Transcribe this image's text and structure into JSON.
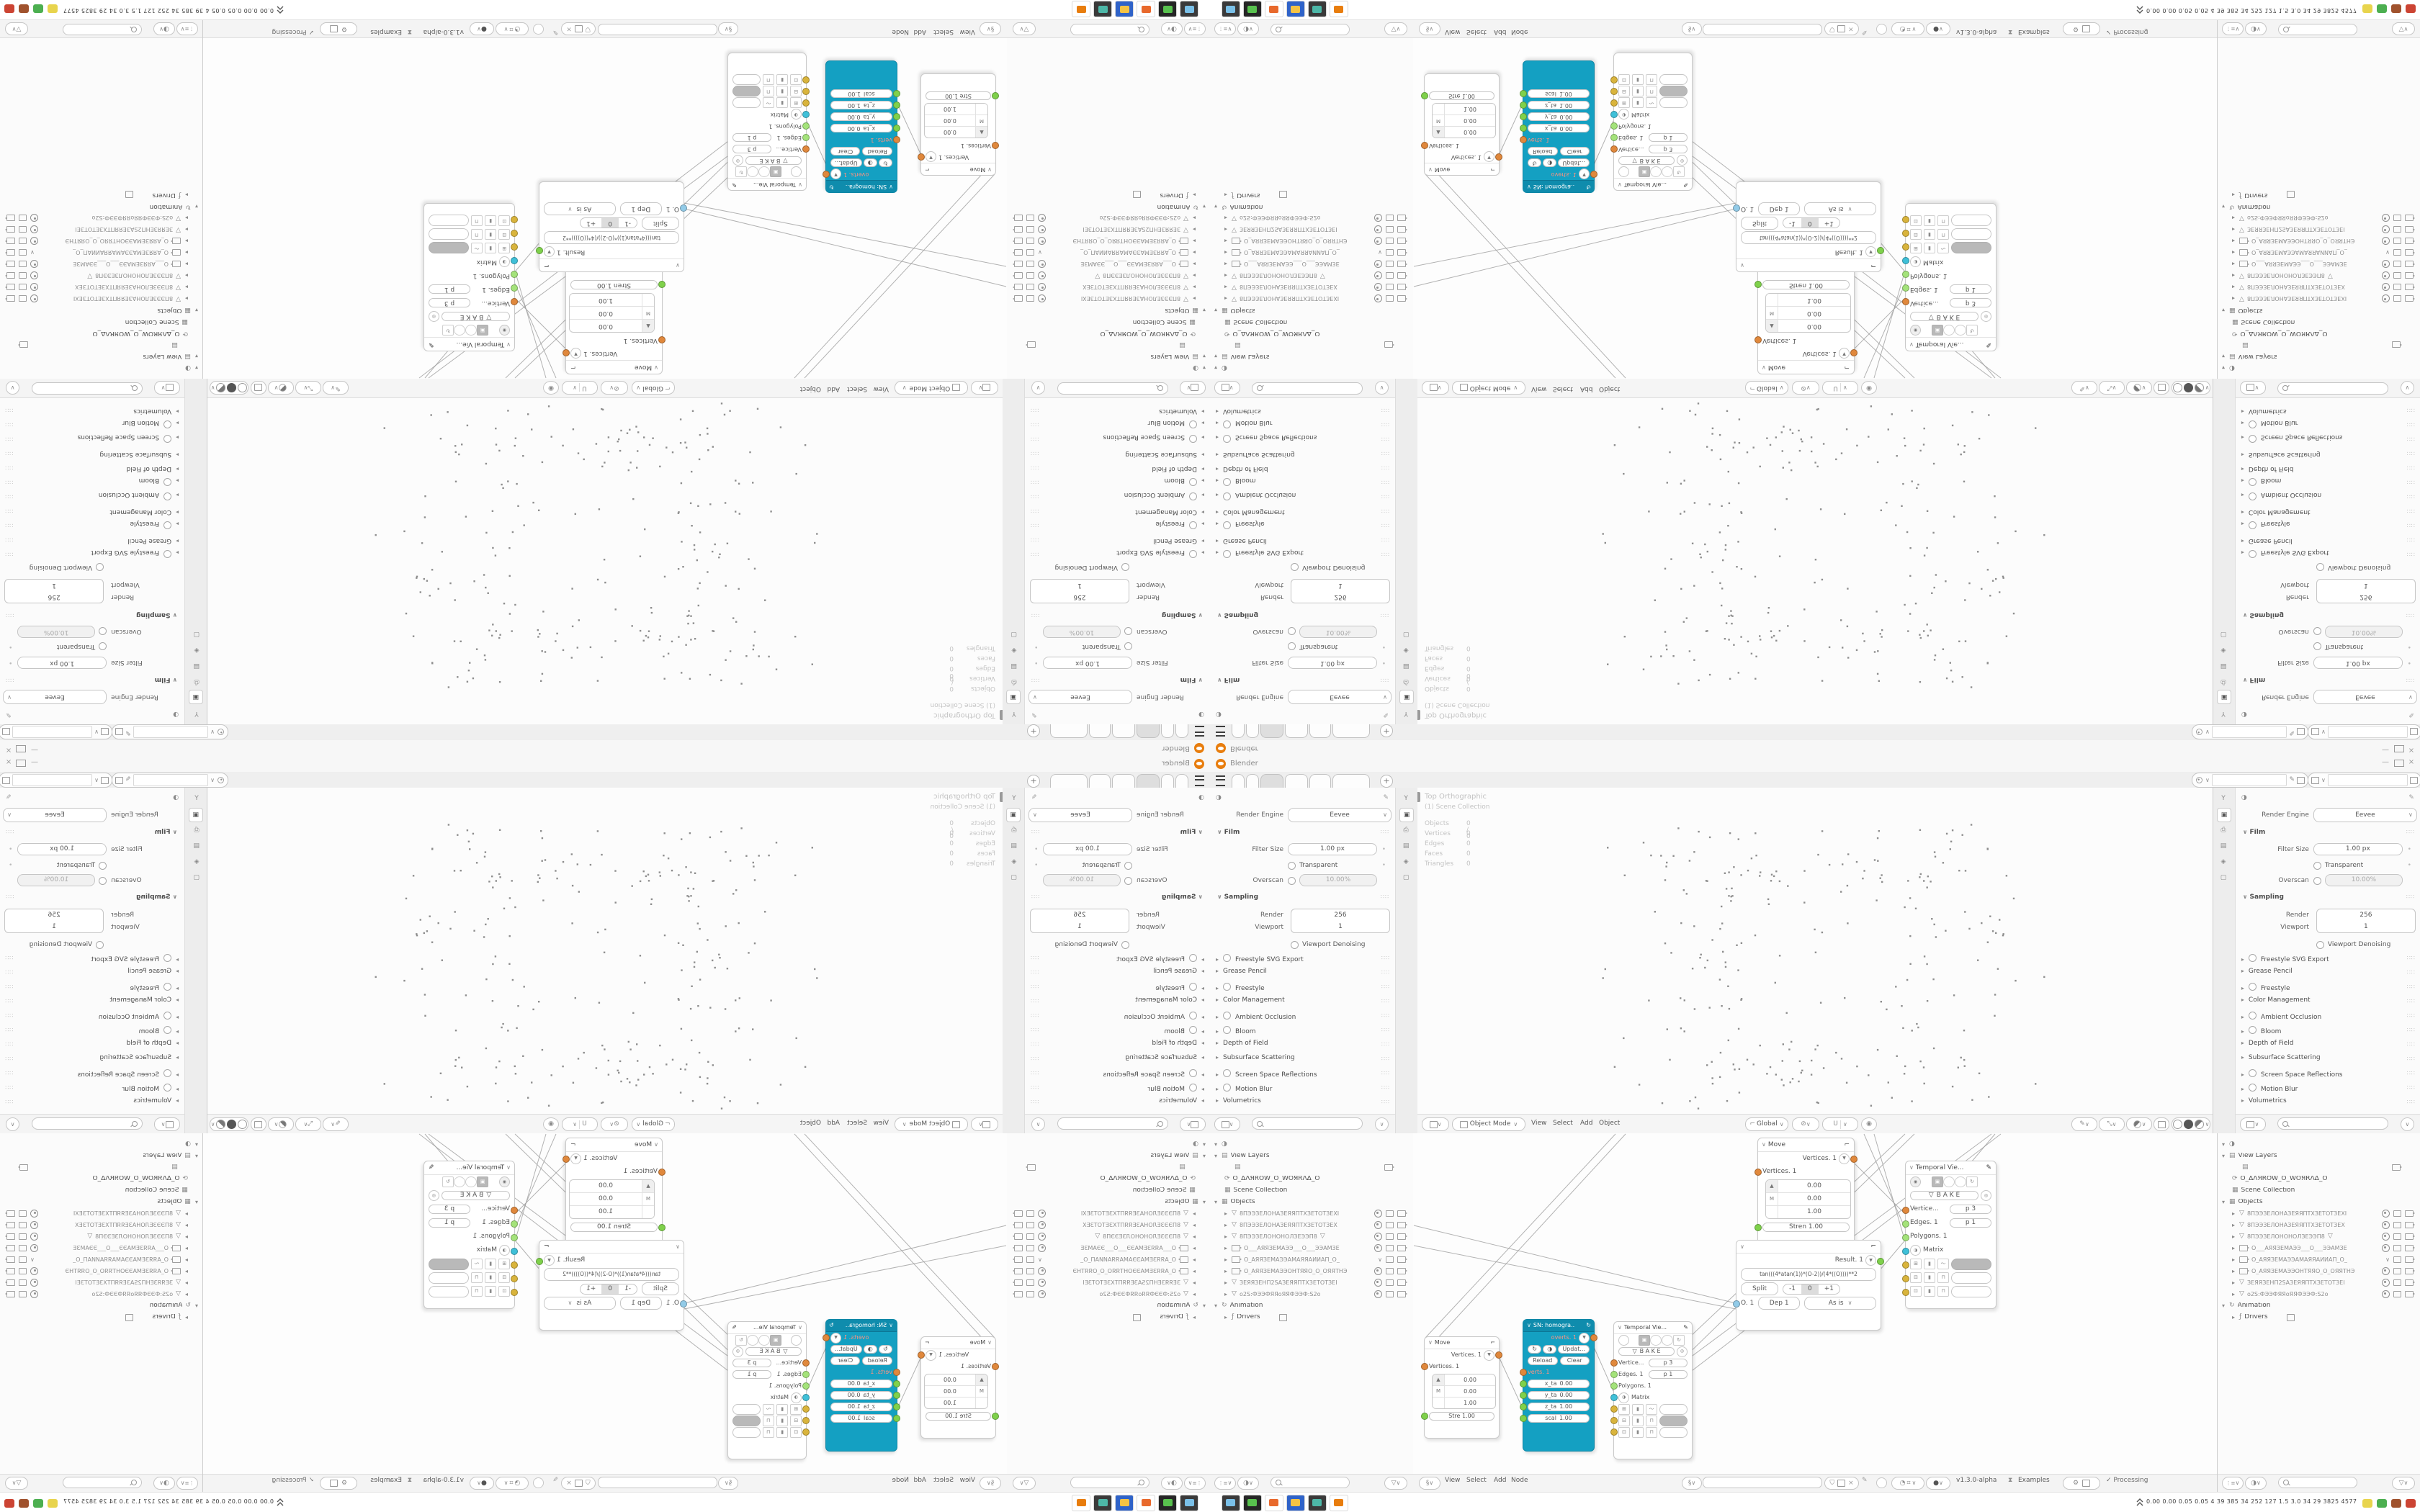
{
  "window": {
    "title": "Blender",
    "controls": [
      "minimize",
      "maximize",
      "close"
    ]
  },
  "workspace_tabs": {
    "items": [
      {
        "w": 16
      },
      {
        "w": 16
      },
      {
        "w": 30,
        "active": true
      },
      {
        "w": 30
      },
      {
        "w": 28
      },
      {
        "w": 50
      }
    ],
    "add_label": "+"
  },
  "properties_panel": {
    "render_engine_label": "Render Engine",
    "render_engine_value": "Eevee",
    "film_section": "Film",
    "filter_size_label": "Filter Size",
    "filter_size_value": "1.00 px",
    "transparent_label": "Transparent",
    "overscan_label": "Overscan",
    "overscan_value": "10.00%",
    "sampling_section": "Sampling",
    "render_label": "Render",
    "render_value": "256",
    "viewport_label": "Viewport",
    "viewport_value": "1",
    "denoising_label": "Viewport Denoising",
    "collapsed": [
      {
        "label": "Freestyle SVG Export",
        "checkbox": true
      },
      {
        "label": "Grease Pencil",
        "checkbox": false
      },
      {
        "label": "Freestyle",
        "checkbox": true
      },
      {
        "label": "Color Management",
        "checkbox": false
      },
      {
        "label": "Ambient Occlusion",
        "checkbox": true
      },
      {
        "label": "Bloom",
        "checkbox": true
      },
      {
        "label": "Depth of Field",
        "checkbox": false
      },
      {
        "label": "Subsurface Scattering",
        "checkbox": false
      },
      {
        "label": "Screen Space Reflections",
        "checkbox": true
      },
      {
        "label": "Motion Blur",
        "checkbox": true
      },
      {
        "label": "Volumetrics",
        "checkbox": false
      }
    ]
  },
  "viewport": {
    "overlay_line1": "Top Orthographic",
    "overlay_line2": "(1) Scene Collection",
    "stats": [
      {
        "label": "Objects",
        "value": "0 / 0"
      },
      {
        "label": "Vertices",
        "value": "0"
      },
      {
        "label": "Edges",
        "value": "0"
      },
      {
        "label": "Faces",
        "value": "0"
      },
      {
        "label": "Triangles",
        "value": "0"
      }
    ],
    "header": {
      "mode": "Object Mode",
      "menus": [
        "View",
        "Select",
        "Add",
        "Object"
      ],
      "orientation": "Global"
    }
  },
  "outliner": {
    "view_layers_label": "View Layers",
    "scene_name": "O_ΔΛЯROW_O_WOЯRΛΔ_O",
    "scene_collection_label": "Scene Collection",
    "objects_label": "Objects",
    "animation_label": "Animation",
    "drivers_label": "Drivers",
    "objects": [
      {
        "type": "mesh",
        "name": "8ПЭЭЗЕЛОНАЗЕЯЯПТХЗЕТОТЗЕХІ",
        "eye": "on"
      },
      {
        "type": "mesh",
        "name": "8ПЭЭЗЕЛОНАЗЕЯЯПТХЗЕТОТЗЕХ",
        "eye": "on"
      },
      {
        "type": "mesh",
        "name": "8ПЭЭЗЕЛОНОНОЛЗЕЭЭП8",
        "eye": "on",
        "extra_mesh": true
      },
      {
        "type": "camera",
        "name": "О___АЯЯЗЕМАЭЭ___О___ЭЭАМЗЕ",
        "eye": "on"
      },
      {
        "type": "camera",
        "name": "О_АЯЯЗЕМАЭЭАМАЯЯАИИАП_О_",
        "eye": "chev"
      },
      {
        "type": "camera",
        "name": "О_АЯЯЗЕМАЭЭОНТЯЯО_О_ОЯЯТНЭ",
        "eye": "on"
      },
      {
        "type": "mesh",
        "name": "ЗЕЯЯЗЕНП2SАЗЕЯЯПТХЗЕТОТЗЕІ",
        "eye": "on"
      },
      {
        "type": "mesh",
        "name": "о2S:ФЭЭФЯЯоЯЯФЭЭФ:S2о",
        "eye": "on",
        "locked": true
      }
    ]
  },
  "node_editor": {
    "menus": [
      "View",
      "Select",
      "Add",
      "Node"
    ],
    "status": {
      "version": "v1.3.0-alpha",
      "examples": "Examples",
      "processing": "Processing"
    },
    "nodes": {
      "move_a": {
        "title": "Move",
        "out": "Vertices. 1",
        "in": "Vertices. 1",
        "m_label": "M",
        "v0": "0.00",
        "v1": "0.00",
        "v2": "1.00",
        "stren": "Stre  1.00"
      },
      "move_d": {
        "title": "Move",
        "out": "Vertices. 1",
        "in": "Vertices. 1",
        "m_label": "M",
        "v0": "0.00",
        "v1": "0.00",
        "v2": "1.00",
        "stren": "Stren  1.00"
      },
      "sn_b": {
        "title": "SN: homogra..",
        "out": "overts. 1",
        "update": "Updat...",
        "reload": "Reload",
        "clear": "Clear",
        "verts": "verts. 1",
        "fields": [
          {
            "k": "x_ta",
            "v": "0.00"
          },
          {
            "k": "y_ta",
            "v": "0.00"
          },
          {
            "k": "z_ta",
            "v": "1.00"
          },
          {
            "k": "scal",
            "v": "1.00"
          }
        ]
      },
      "tv_c": {
        "title": "Temporal Vie...",
        "bake": "B A K E",
        "s1": "Vertice...",
        "s1v": "p  3",
        "s2": "Edges. 1",
        "s2v": "p  1",
        "s3": "Polygons. 1",
        "s4": "Matrix",
        "gray_row": 1
      },
      "tv_f": {
        "title": "Temporal Vie...",
        "bake": "B A K E",
        "s1": "Vertice...",
        "s1v": "p  3",
        "s2": "Edges. 1",
        "s2v": "p  1",
        "s3": "Polygons. 1",
        "s4": "Matrix",
        "gray_row": 0
      },
      "result_e": {
        "out": "Result. 1",
        "formula": "tan(((4*atan(1))*(O-2))/(4*((O))))**2",
        "split": "Split",
        "seg": [
          "-1",
          "0",
          "+1"
        ],
        "seg_selected": 1,
        "in": "O. 1",
        "dep": "Dep  1",
        "mode": "As is"
      }
    }
  },
  "taskbar": {
    "monitor_values": "0.00 0.00 0.05 0.05    4     39    385    34    252   127    1.5    3.0    34     29   3825 4577",
    "left_icons": [
      {
        "name": "screenshot-tool-icon",
        "bg": "#3a3a3a",
        "fg": "#7ac0e8"
      },
      {
        "name": "system-monitor-icon",
        "bg": "#262626",
        "fg": "#58c24e"
      },
      {
        "name": "firefox-icon",
        "bg": "#ffffff",
        "fg": "#e8692c"
      },
      {
        "name": "gimp-64-icon",
        "bg": "#2f63c9",
        "fg": "#f5c344"
      },
      {
        "name": "image-viewer-icon",
        "bg": "#3a3a3a",
        "fg": "#4db8a8"
      },
      {
        "name": "blender-icon",
        "bg": "#ffffff",
        "fg": "#e87d0d"
      }
    ],
    "right_icons": [
      "#e8d44d",
      "#4caf50",
      "#a0522d",
      "#cc4433"
    ]
  },
  "colors": {
    "accent_cyan": "#14a0c2",
    "socket_orange": "#e0883c",
    "socket_green": "#7fd14b",
    "socket_cyan": "#3fc0d8",
    "socket_yellow": "#d9b43c",
    "socket_blue": "#92cbe8",
    "dot_gray": "#8e8e8e",
    "blender_orange": "#e87d0d"
  }
}
